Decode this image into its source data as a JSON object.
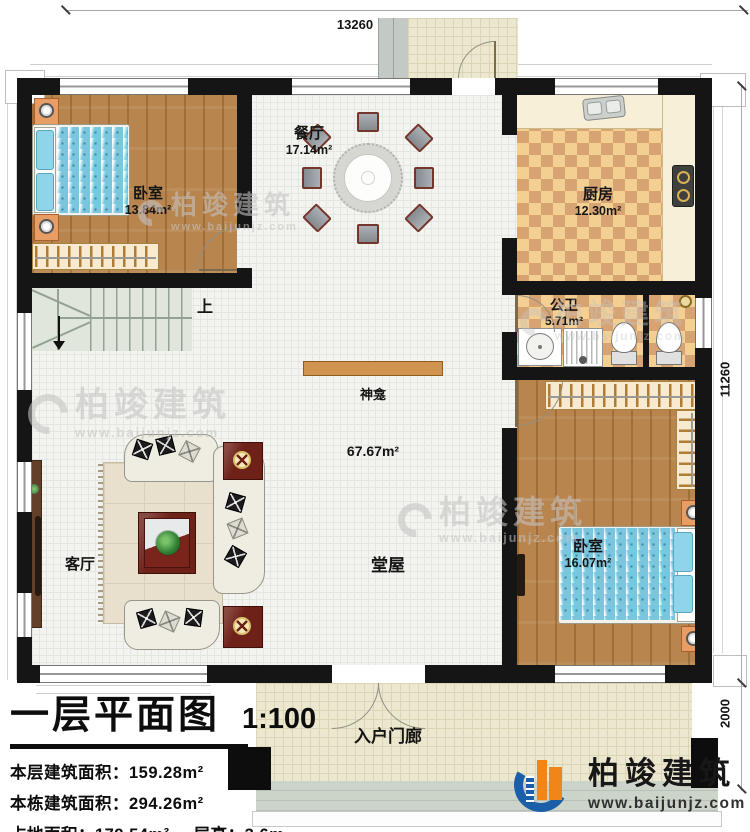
{
  "dimensions": {
    "top": "13260",
    "right_main": "11260",
    "right_porch": "2000"
  },
  "rooms": {
    "bedroom1": {
      "name": "卧室",
      "area": "13.84m²"
    },
    "dining": {
      "name": "餐厅",
      "area": "17.14m²"
    },
    "kitchen": {
      "name": "厨房",
      "area": "12.30m²"
    },
    "bathroom": {
      "name": "公卫",
      "area": "5.71m²"
    },
    "bedroom2": {
      "name": "卧室",
      "area": "16.07m²"
    },
    "living": {
      "name": "客厅"
    },
    "hall": {
      "name": "堂屋",
      "area": "67.67m²"
    },
    "shrine": {
      "name": "神龛"
    },
    "porch": {
      "name": "入户门廊"
    },
    "stairs": {
      "up_label": "上"
    }
  },
  "titleblock": {
    "title": "一层平面图",
    "scale": "1:100",
    "stats": [
      {
        "label": "本层建筑面积：",
        "value": "159.28m²"
      },
      {
        "label": "本栋建筑面积：",
        "value": "294.26m²"
      },
      {
        "label": "占地面积：",
        "value": "179.54m²",
        "label2": "层高：",
        "value2": "3.6m"
      }
    ]
  },
  "brand": {
    "name": "柏竣建筑",
    "url": "www.baijunjz.com"
  },
  "watermark": {
    "name": "柏竣建筑",
    "url": "www.baijunjz.com"
  },
  "colors": {
    "wall": "#151515",
    "wood_floor": "#b9854e",
    "checker_light": "#f3cf92",
    "checker_dark": "#d7a373",
    "brand_blue": "#1a5fa8",
    "brand_orange": "#f08519"
  }
}
